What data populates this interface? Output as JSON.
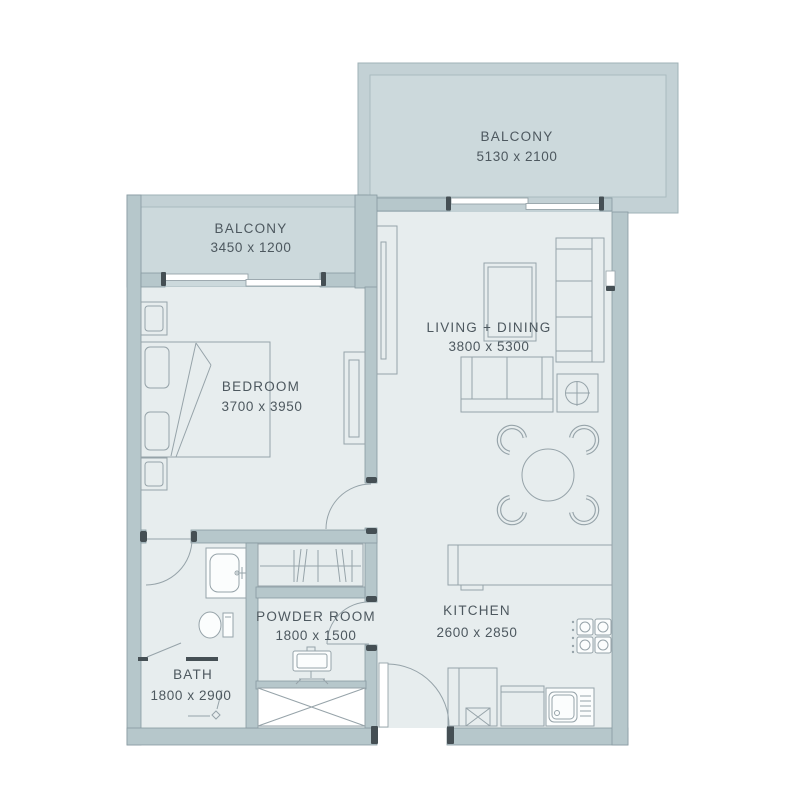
{
  "title": "Apartment Floor Plan",
  "rooms": [
    {
      "id": "balcony-right",
      "name": "BALCONY",
      "dims": "5130 x 2100"
    },
    {
      "id": "balcony-left",
      "name": "BALCONY",
      "dims": "3450 x 1200"
    },
    {
      "id": "living-dining",
      "name": "LIVING + DINING",
      "dims": "3800 x 5300"
    },
    {
      "id": "bedroom",
      "name": "BEDROOM",
      "dims": "3700 x 3950"
    },
    {
      "id": "kitchen",
      "name": "KITCHEN",
      "dims": "2600 x 2850"
    },
    {
      "id": "powder-room",
      "name": "POWDER ROOM",
      "dims": "1800 x 1500"
    },
    {
      "id": "bath",
      "name": "BATH",
      "dims": "1800 x 2900"
    }
  ],
  "colors": {
    "background": "#ffffff",
    "balcony_wall": "#c3d1d5",
    "balcony_floor": "#ccd9dc",
    "room_floor": "#e7edee",
    "wall_fill": "#b6c7cb",
    "wall_edge": "#8799a0",
    "furniture_line": "#96a3a9",
    "dark_accent": "#454f54",
    "text": "#4d585f"
  },
  "fixtures": [
    "bed",
    "nightstand",
    "wardrobe",
    "tv-console",
    "sofa",
    "loveseat",
    "coffee-table",
    "side-table-lamp",
    "dining-table-4-chairs",
    "kitchen-counter",
    "stove-4-burner",
    "refrigerator",
    "dishwasher",
    "kitchen-sink",
    "vanity-sink",
    "toilet",
    "shower-drain",
    "closet-hangers",
    "washbasin",
    "service-shaft"
  ]
}
